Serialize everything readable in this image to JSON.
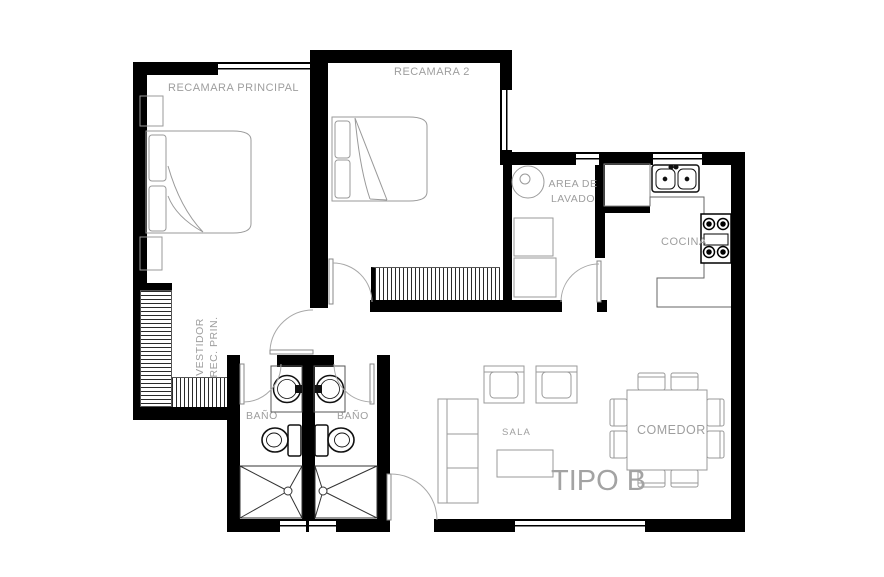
{
  "plan_title": "TIPO B",
  "labels": {
    "master_bedroom": "RECAMARA PRINCIPAL",
    "bedroom_2": "RECAMARA 2",
    "laundry_line1": "AREA DE",
    "laundry_line2": "LAVADO",
    "kitchen": "COCINA",
    "closet_line1": "VESTIDOR",
    "closet_line2": "REC. PRIN.",
    "bathroom_left": "BAÑO",
    "bathroom_right": "BAÑO",
    "living_room": "SALA",
    "dining_room": "COMEDOR",
    "plan_type": "TIPO B"
  },
  "colors": {
    "wall": "#000000",
    "furniture_stroke": "#9a9a9a",
    "fixture_stroke": "#1a1a1a",
    "label_text": "#9e9e9e",
    "background": "#ffffff"
  }
}
